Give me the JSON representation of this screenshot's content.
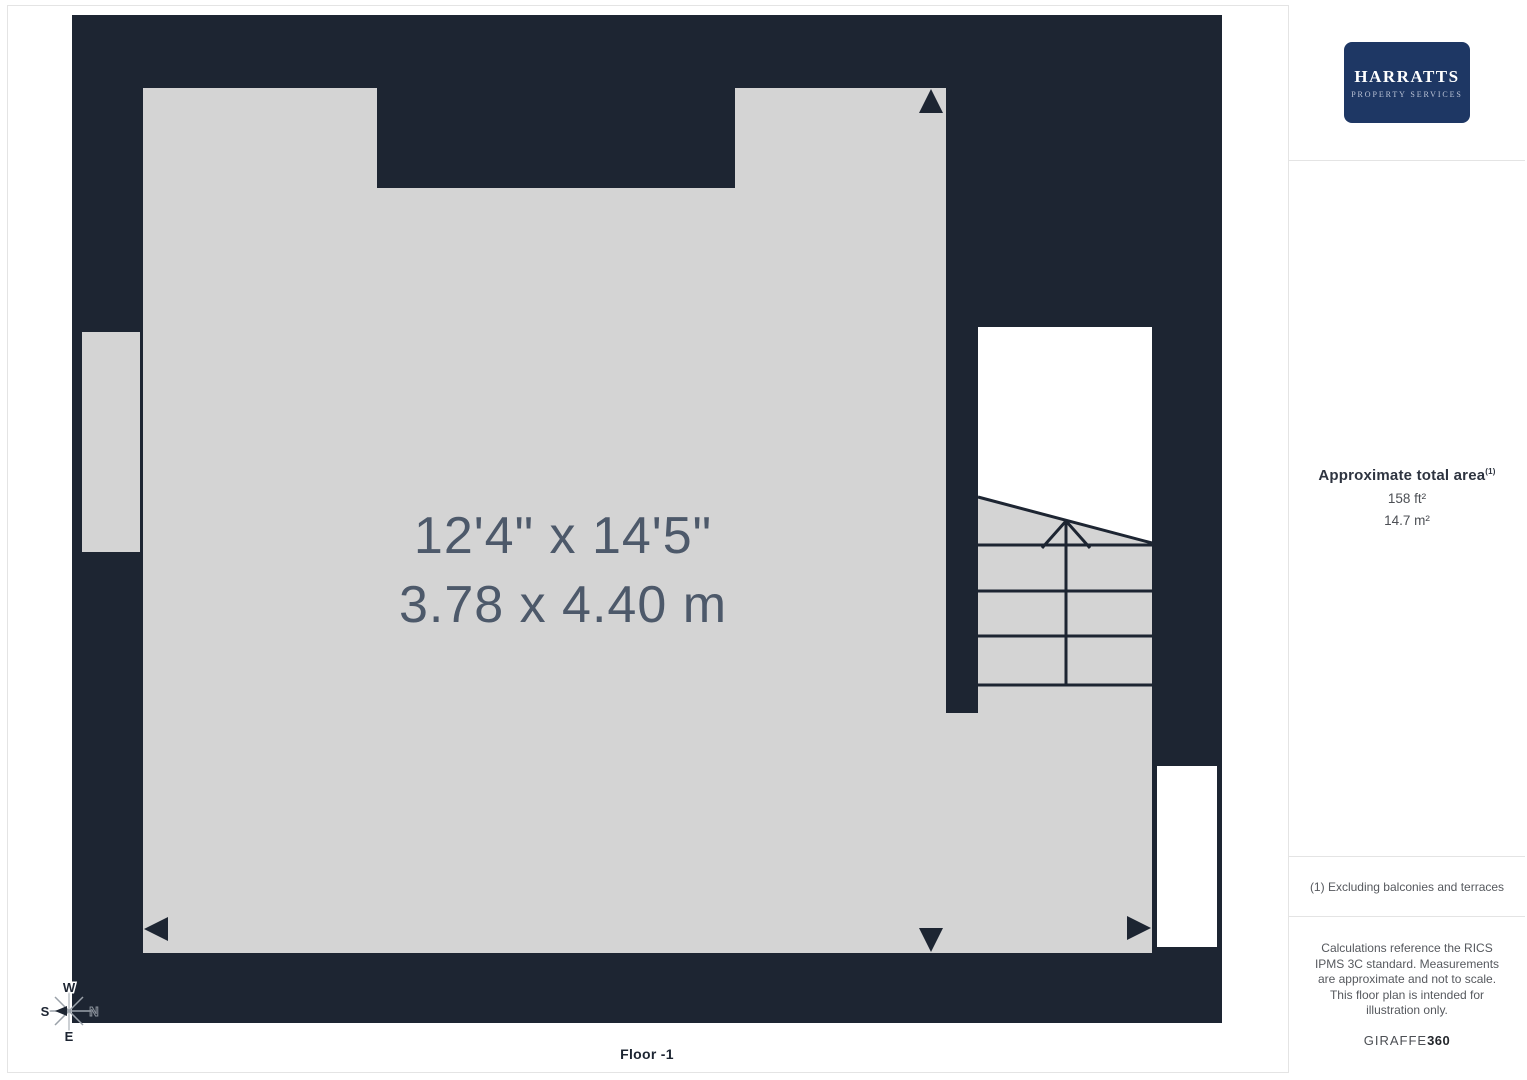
{
  "plan": {
    "room": {
      "imperial": "12'4\" x 14'5\"",
      "metric": "3.78 x 4.40 m"
    },
    "floor_label": "Floor -1",
    "compass": {
      "north": "N",
      "east": "E",
      "south": "S",
      "west": "W"
    },
    "colors": {
      "wall": "#1d2532",
      "floor": "#d4d4d4",
      "dimension_text": "#4d596a",
      "stair_void": "#ffffff"
    }
  },
  "sidebar": {
    "logo": {
      "name": "HARRATTS",
      "tagline": "PROPERTY SERVICES",
      "bg": "#1e3764"
    },
    "area": {
      "heading": "Approximate total area",
      "sup": "(1)",
      "imperial": "158 ft²",
      "metric": "14.7 m²"
    },
    "footnote": "(1) Excluding balconies and terraces",
    "disclaimer": "Calculations reference the RICS IPMS 3C standard. Measurements are approximate and not to scale. This floor plan is intended for illustration only.",
    "brand": {
      "name": "GIRAFFE",
      "suffix": "360"
    }
  }
}
